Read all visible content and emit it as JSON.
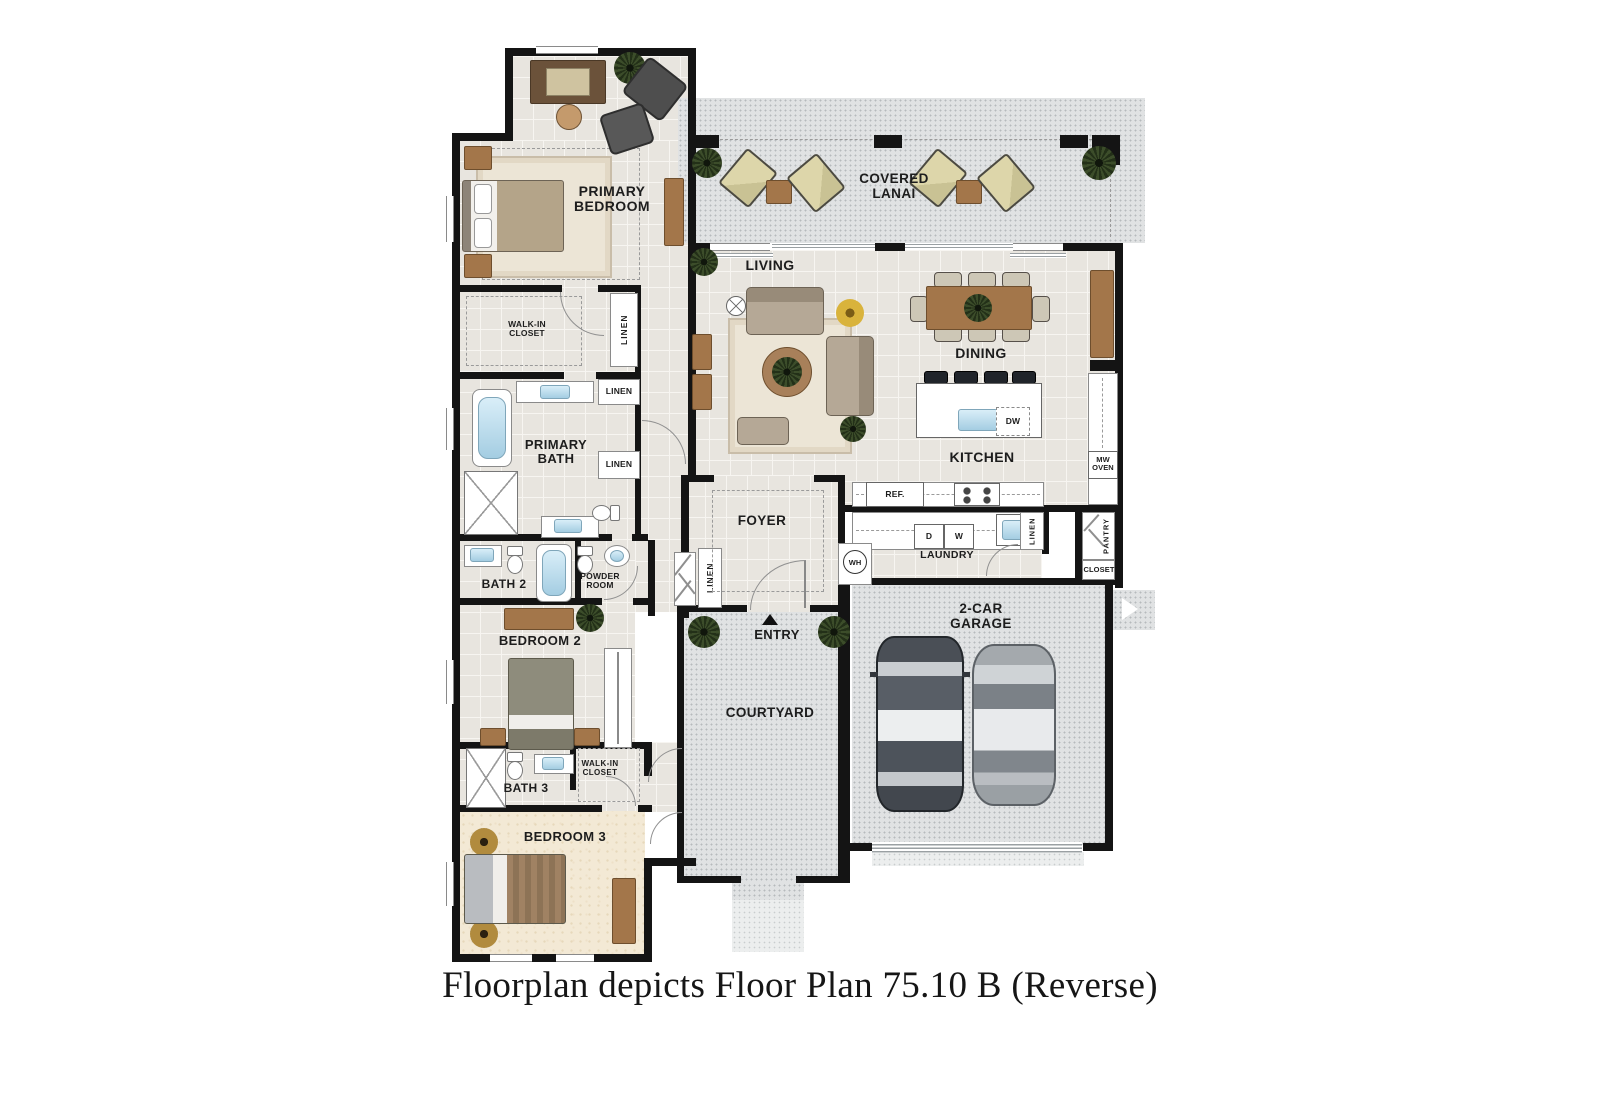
{
  "caption": "Floorplan depicts Floor Plan 75.10 B (Reverse)",
  "rooms": {
    "primary_bedroom": "PRIMARY BEDROOM",
    "covered_lanai": "COVERED LANAI",
    "living": "LIVING",
    "dining": "DINING",
    "kitchen": "KITCHEN",
    "walk_in_closet": "WALK-IN CLOSET",
    "primary_bath": "PRIMARY BATH",
    "bath_2": "BATH 2",
    "powder_room": "POWDER ROOM",
    "bedroom_2": "BEDROOM 2",
    "bath_3": "BATH 3",
    "bedroom_3": "BEDROOM 3",
    "foyer": "FOYER",
    "entry": "ENTRY",
    "courtyard": "COURTYARD",
    "laundry": "LAUNDRY",
    "garage": "2-CAR GARAGE"
  },
  "labels": {
    "linen": "LINEN",
    "ref": "REF.",
    "dryer": "D",
    "washer": "W",
    "dishwasher": "DW",
    "water_heater": "WH",
    "mw_oven": "MW OVEN",
    "pantry": "PANTRY",
    "closet": "CLOSET"
  },
  "colors": {
    "wall": "#141414",
    "tile_floor": "#e8e5df",
    "carpet_floor": "#f3e9d5",
    "outdoor_concrete": "#e0e2e3",
    "wood_furniture": "#a3764a",
    "fixture_blue": "#bfe0f0",
    "label_text": "#1d1d1d"
  }
}
